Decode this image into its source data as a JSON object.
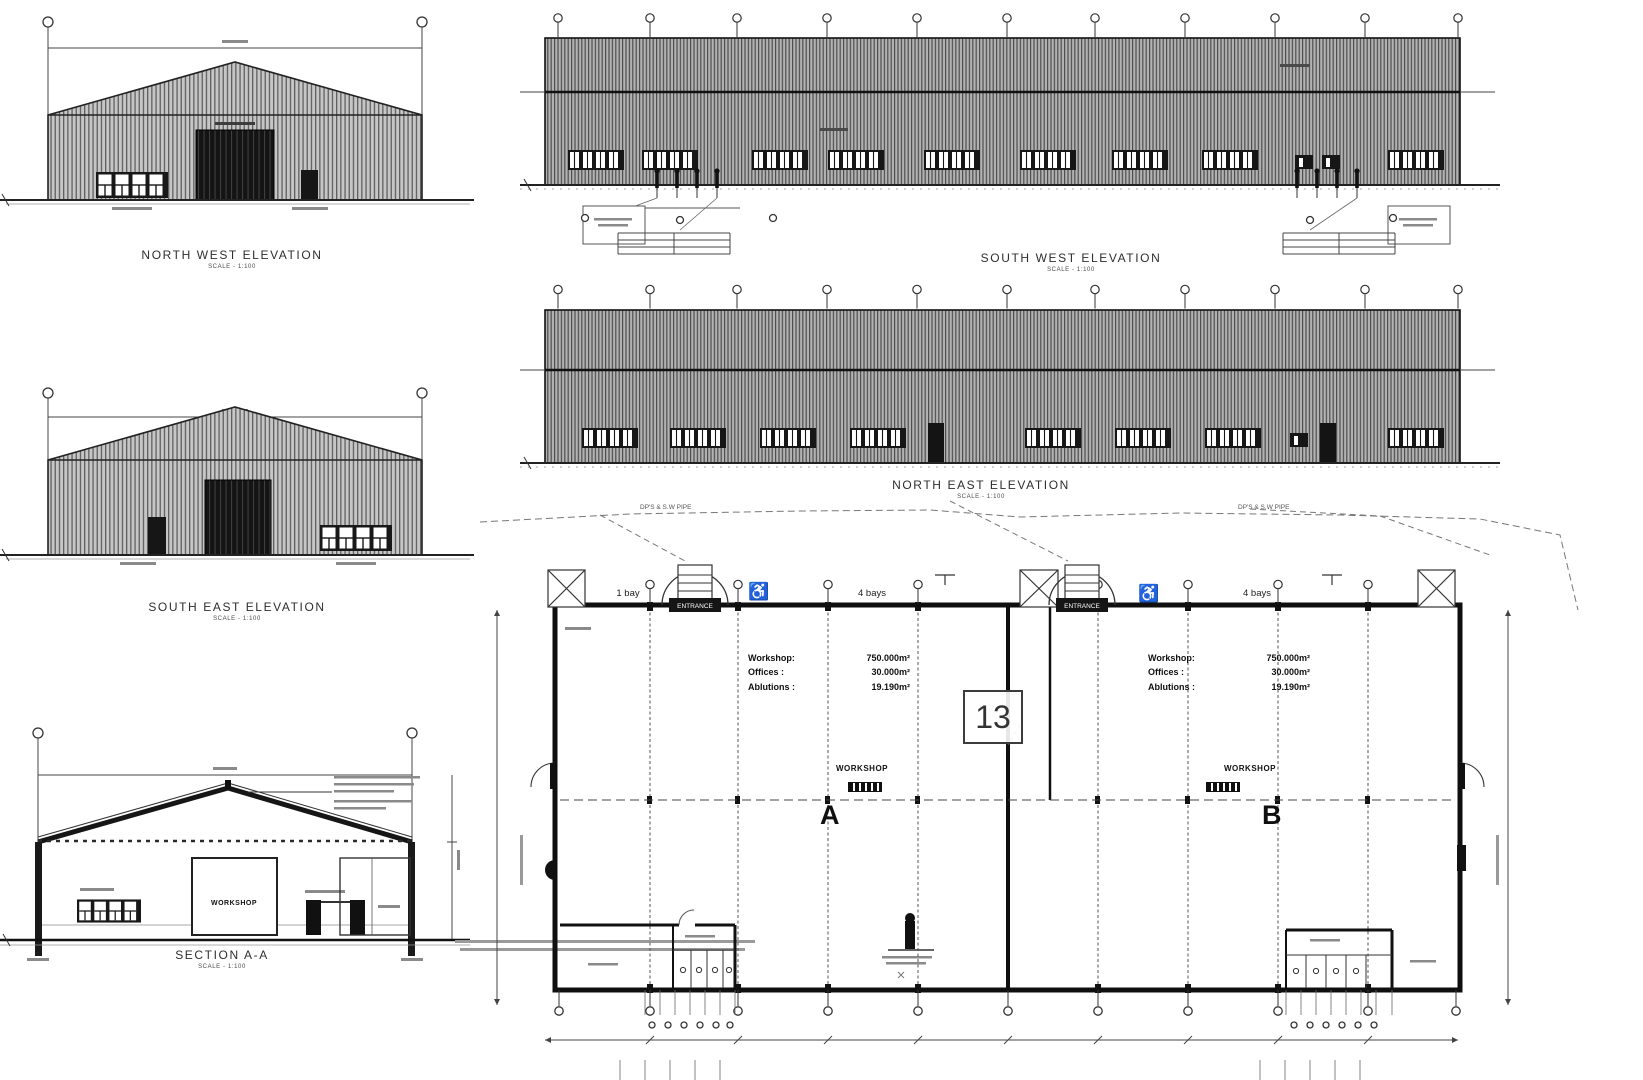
{
  "sheet": {
    "background": "#ffffff",
    "line_ink": "#1c1c1c",
    "cladding_gray": "#bdbdbd",
    "dark_door": "#141414"
  },
  "drawings": {
    "north_west_elevation": {
      "title": "NORTH WEST ELEVATION",
      "scale": "SCALE - 1:100"
    },
    "south_west_elevation": {
      "title": "SOUTH WEST ELEVATION",
      "scale": "SCALE - 1:100"
    },
    "north_east_elevation": {
      "title": "NORTH EAST ELEVATION",
      "scale": "SCALE - 1:100"
    },
    "south_east_elevation": {
      "title": "SOUTH EAST ELEVATION",
      "scale": "SCALE - 1:100"
    },
    "section_aa": {
      "title": "SECTION A-A",
      "scale": "SCALE - 1:100",
      "room_label": "WORKSHOP"
    }
  },
  "floor_plan": {
    "bay_labels": {
      "left": "1 bay",
      "middle": "4 bays",
      "right": "4 bays"
    },
    "entrance_label": "ENTRANCE",
    "accessibility_symbol": "♿",
    "detail_number": "13",
    "workshop_label_a": "WORKSHOP",
    "workshop_label_b": "WORKSHOP",
    "section_marker_a": "A",
    "section_marker_b": "B",
    "roof_notes": {
      "left": "DP'S & S.W PIPE",
      "right": "DP'S & S.W PIPE"
    },
    "areas_left": [
      {
        "label": "Workshop:",
        "value": "750.000m²"
      },
      {
        "label": "Offices :",
        "value": "30.000m²"
      },
      {
        "label": "Ablutions :",
        "value": "19.190m²"
      }
    ],
    "areas_right": [
      {
        "label": "Workshop:",
        "value": "750.000m²"
      },
      {
        "label": "Offices :",
        "value": "30.000m²"
      },
      {
        "label": "Ablutions :",
        "value": "19.190m²"
      }
    ]
  }
}
